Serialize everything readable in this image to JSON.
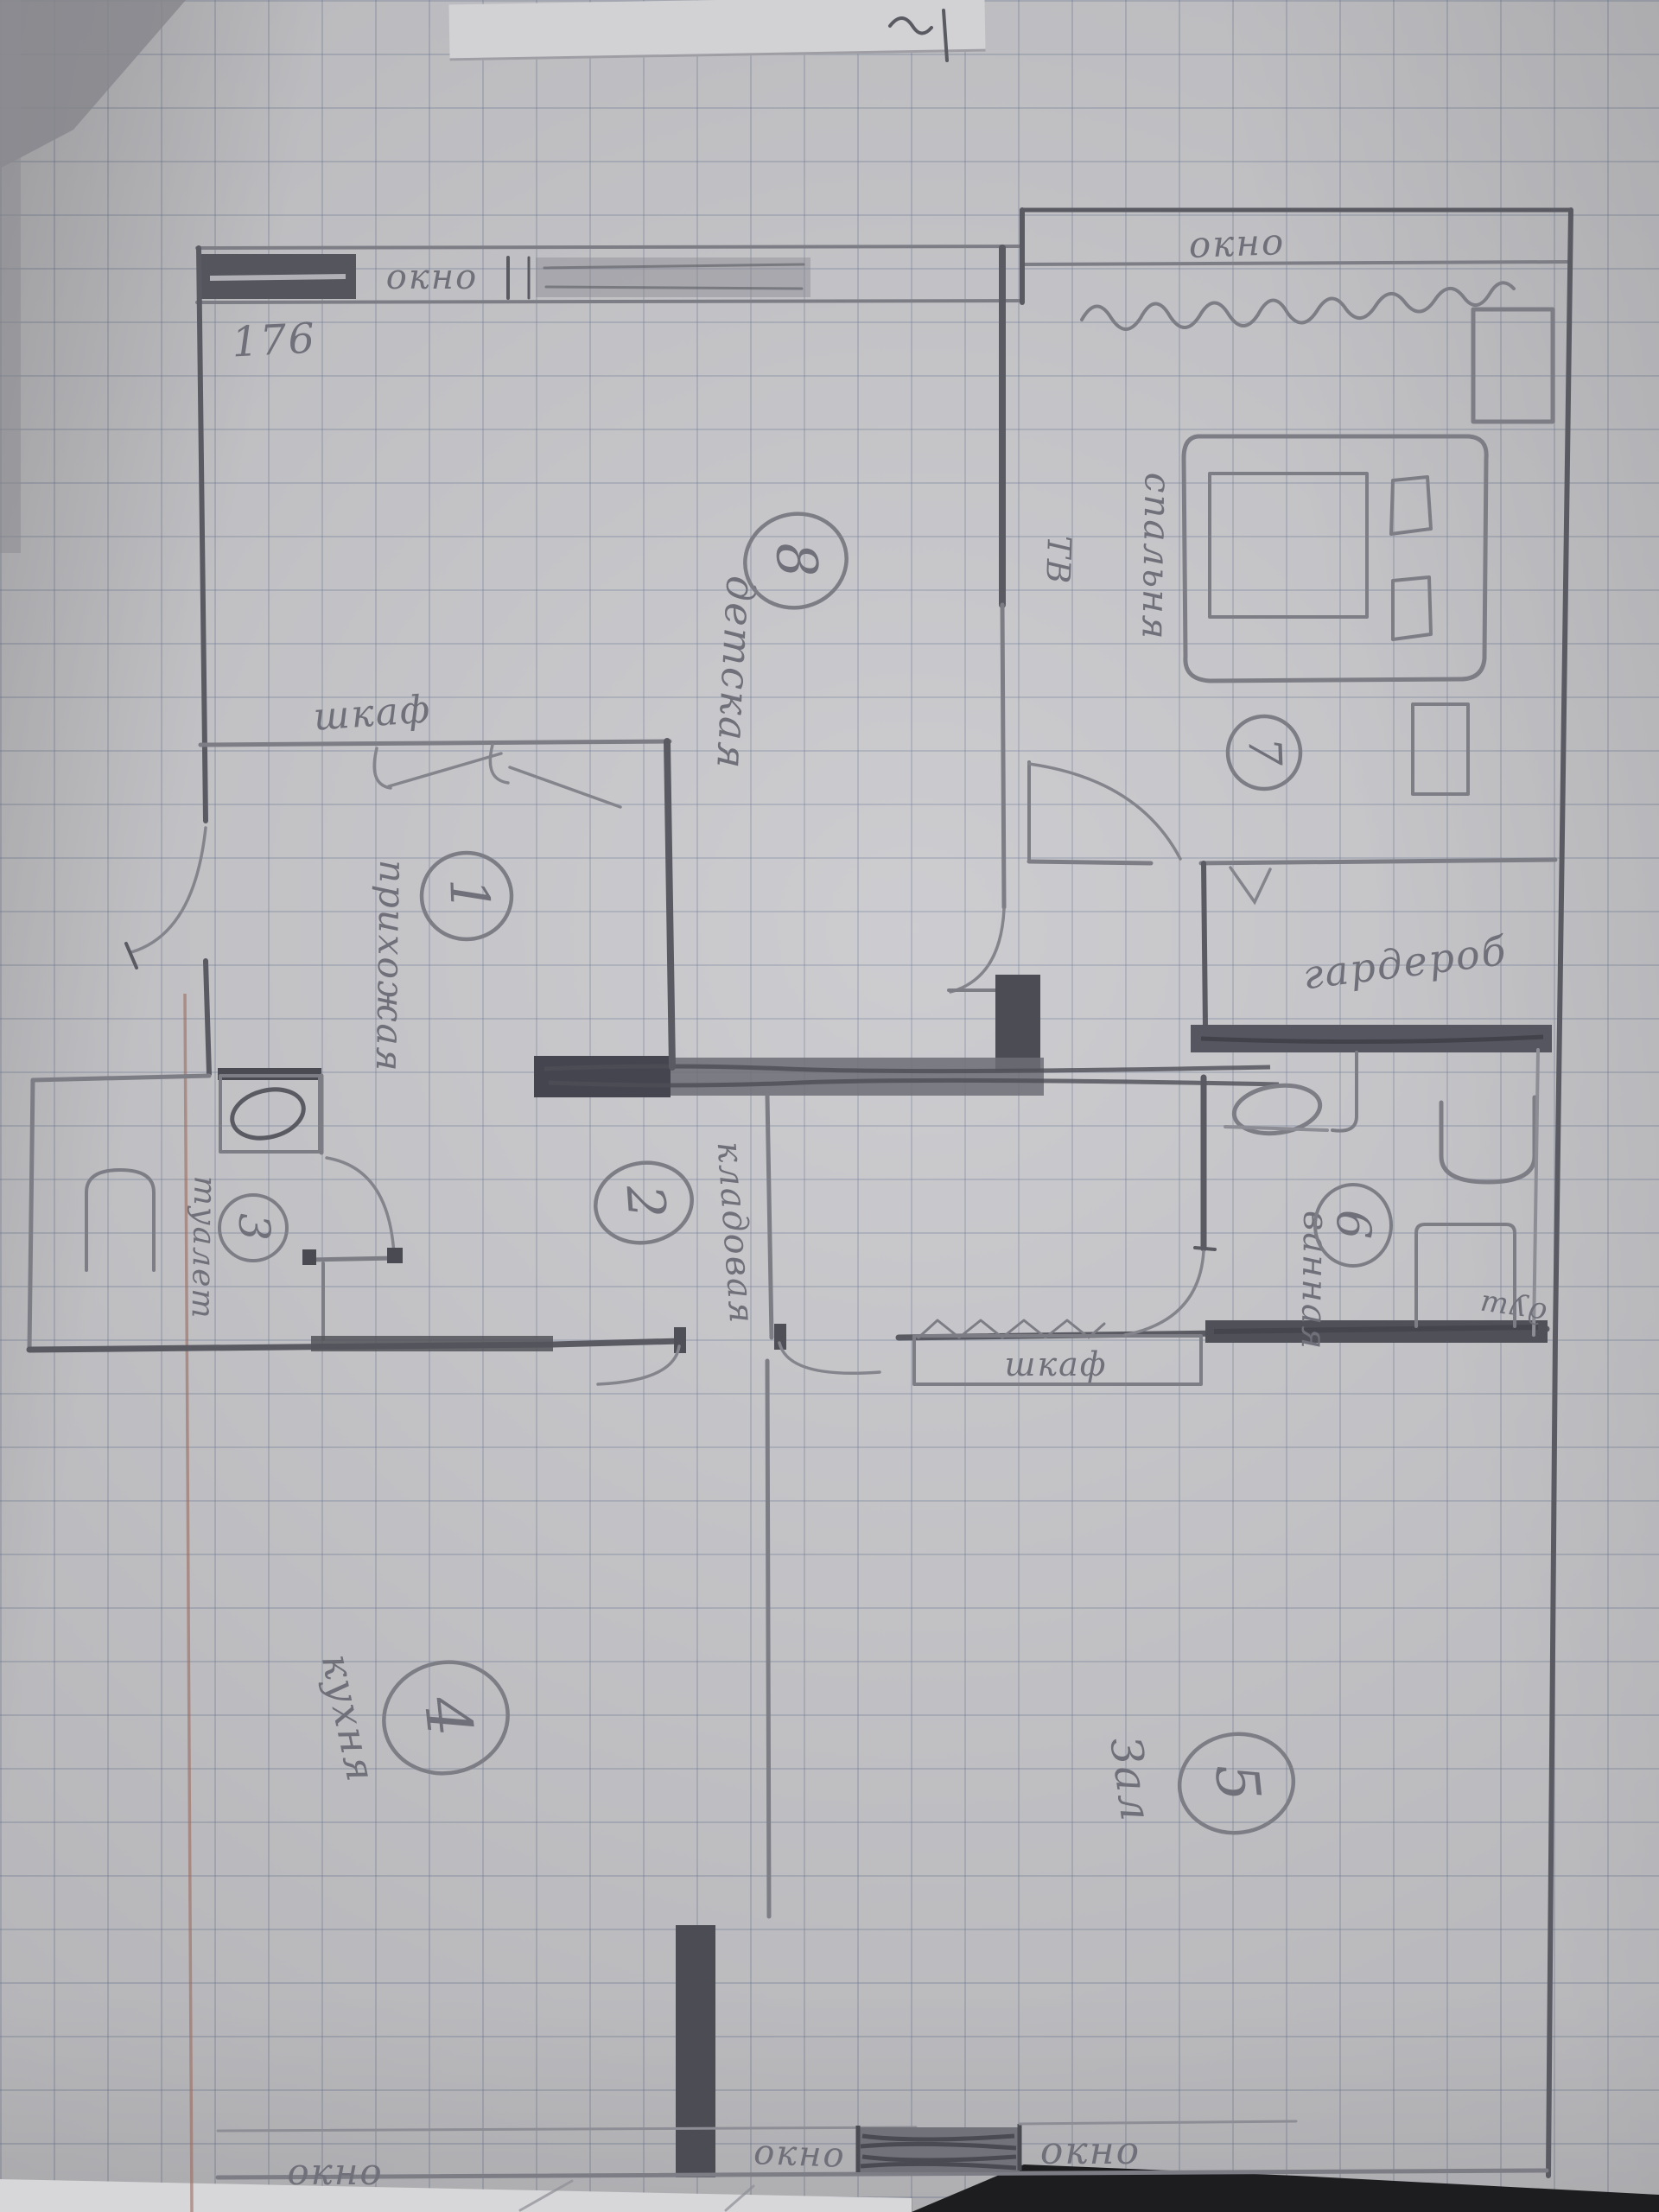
{
  "photo": {
    "page_number": "176"
  },
  "labels": {
    "window": "окно",
    "closet": "шкаф",
    "wardrobe": "гардероб",
    "tv": "ТВ",
    "shower": "душ"
  },
  "rooms": [
    {
      "number": "1",
      "name": "прихожая"
    },
    {
      "number": "2",
      "name": "кладовая"
    },
    {
      "number": "3",
      "name": "туалет"
    },
    {
      "number": "4",
      "name": "кухня"
    },
    {
      "number": "5",
      "name": "Зал"
    },
    {
      "number": "6",
      "name": "ванная"
    },
    {
      "number": "7",
      "name": "спальня"
    },
    {
      "number": "8",
      "name": "детская"
    }
  ]
}
